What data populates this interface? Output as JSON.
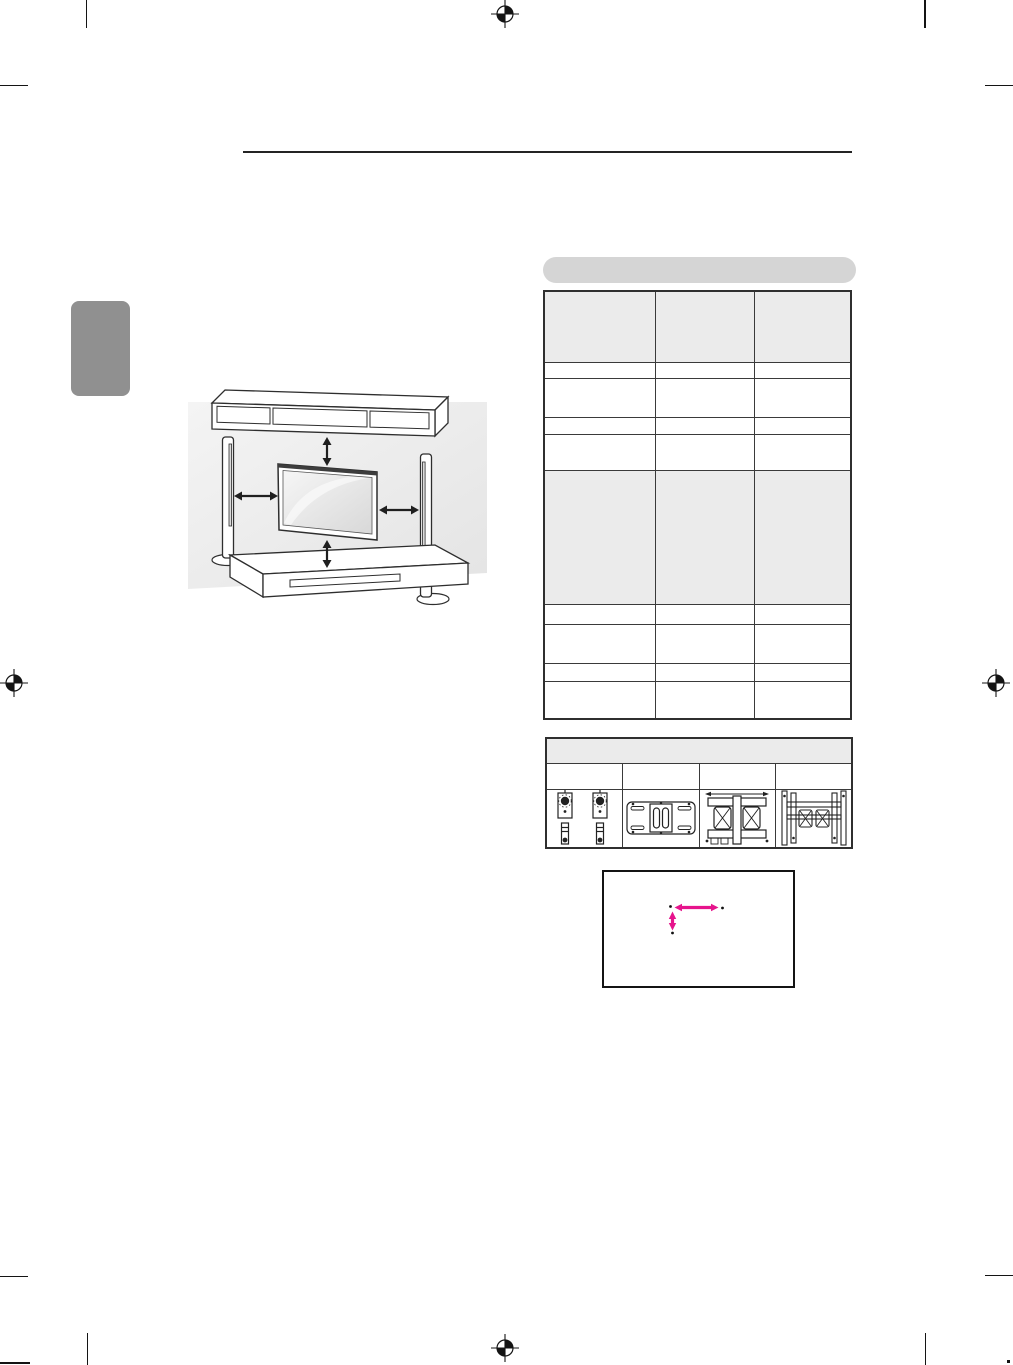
{
  "document": {
    "kind": "print-manual-page",
    "page_background": "#ffffff",
    "visible_text": ""
  },
  "colors": {
    "crop_mark": "#141414",
    "header_rule": "#242424",
    "side_tab": "#909090",
    "pill_banner": "#d5d5d5",
    "table_outer_border": "#2f2f2f",
    "table_inner_border": "#3a3a3a",
    "table_shaded_cell": "#ebebeb",
    "illustration_wall": "#ececec",
    "illustration_line": "#2a2a2a",
    "accent_arrow": "#e6148c"
  },
  "section_banner": {
    "label": ""
  },
  "spacing_table": {
    "column_count": 3,
    "column_widths_px": [
      111,
      99,
      97
    ],
    "rows": [
      {
        "shaded": true,
        "height_px": 71,
        "cells": [
          "",
          "",
          ""
        ]
      },
      {
        "shaded": false,
        "height_px": 16,
        "cells": [
          "",
          "",
          ""
        ]
      },
      {
        "shaded": false,
        "height_px": 39,
        "cells": [
          "",
          "",
          ""
        ]
      },
      {
        "shaded": false,
        "height_px": 17,
        "cells": [
          "",
          "",
          ""
        ]
      },
      {
        "shaded": false,
        "height_px": 36,
        "cells": [
          "",
          "",
          ""
        ]
      },
      {
        "shaded": true,
        "height_px": 134,
        "cells": [
          "",
          "",
          ""
        ]
      },
      {
        "shaded": false,
        "height_px": 20,
        "cells": [
          "",
          "",
          ""
        ]
      },
      {
        "shaded": false,
        "height_px": 39,
        "cells": [
          "",
          "",
          ""
        ]
      },
      {
        "shaded": false,
        "height_px": 18,
        "cells": [
          "",
          "",
          ""
        ]
      },
      {
        "shaded": false,
        "height_px": 38,
        "cells": [
          "",
          "",
          ""
        ]
      }
    ]
  },
  "bracket_table": {
    "header_label": "",
    "column_widths_px": [
      77,
      75,
      79,
      77
    ],
    "label_row": [
      "",
      "",
      "",
      ""
    ],
    "image_row_icons": [
      "wall-bracket-pair-icon",
      "flat-mount-plate-icon",
      "articulating-mount-icon",
      "dual-rail-mount-icon"
    ]
  },
  "clearance_illustration": {
    "elements": [
      "wall",
      "shelf-unit",
      "left-tower-speaker",
      "right-tower-speaker",
      "flat-tv",
      "media-cabinet"
    ],
    "arrows": [
      "top-clearance-arrow",
      "bottom-clearance-arrow",
      "left-clearance-arrow",
      "right-clearance-arrow"
    ]
  },
  "vesa_box": {
    "horizontal_arrow": "width-measure-arrow",
    "vertical_arrow": "height-measure-arrow",
    "arrow_color": "#e6148c"
  }
}
